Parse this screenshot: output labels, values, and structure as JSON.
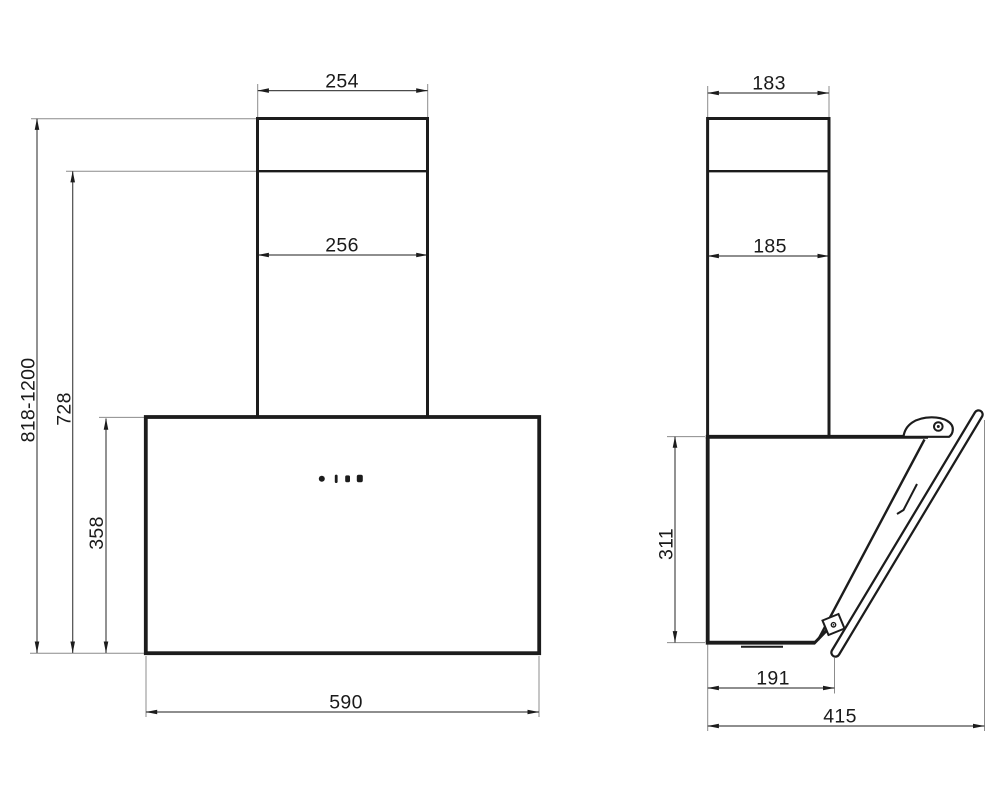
{
  "colors": {
    "outline": "#1c1c1c",
    "dimension": "#4a4a4a",
    "extension": "#8c8c8c",
    "label": "#1a1a1a",
    "background": "#ffffff"
  },
  "dimensions": {
    "front": {
      "chimney_top_width": "254",
      "chimney_width": "256",
      "mounting_height_range": "818-1200",
      "chimney_height": "728",
      "body_height": "358",
      "body_width": "590"
    },
    "side": {
      "chimney_top_depth": "183",
      "chimney_depth": "185",
      "body_height": "311",
      "body_bottom_depth": "191",
      "total_depth": "415"
    }
  }
}
